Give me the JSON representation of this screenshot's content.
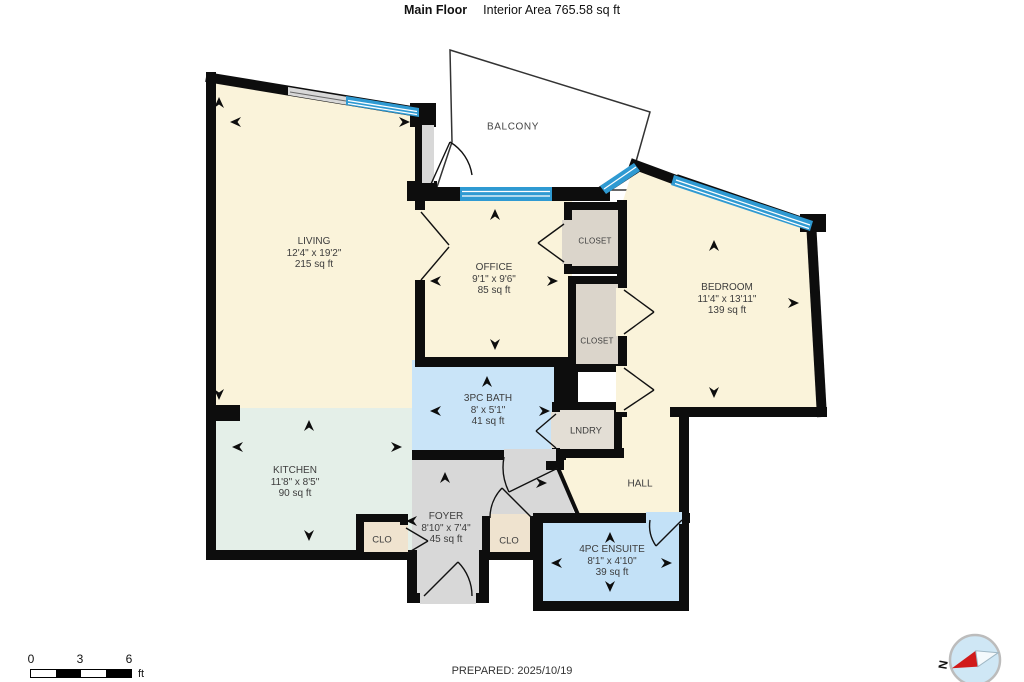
{
  "header": {
    "floor_label": "Main Floor",
    "area_label": "Interior Area 765.58 sq ft"
  },
  "rooms": {
    "living": {
      "name": "LIVING",
      "dims": "12'4\" x 19'2\"",
      "area": "215 sq ft"
    },
    "office": {
      "name": "OFFICE",
      "dims": "9'1\" x 9'6\"",
      "area": "85 sq ft"
    },
    "bedroom": {
      "name": "BEDROOM",
      "dims": "11'4\" x 13'11\"",
      "area": "139 sq ft"
    },
    "kitchen": {
      "name": "KITCHEN",
      "dims": "11'8\" x 8'5\"",
      "area": "90 sq ft"
    },
    "bath": {
      "name": "3PC BATH",
      "dims": "8' x 5'1\"",
      "area": "41 sq ft"
    },
    "foyer": {
      "name": "FOYER",
      "dims": "8'10\" x 7'4\"",
      "area": "45 sq ft"
    },
    "ensuite": {
      "name": "4PC ENSUITE",
      "dims": "8'1\" x 4'10\"",
      "area": "39 sq ft"
    },
    "balcony": {
      "name": "BALCONY"
    },
    "closet_upper": {
      "name": "CLOSET"
    },
    "closet_lower": {
      "name": "CLOSET"
    },
    "laundry": {
      "name": "LNDRY"
    },
    "hall": {
      "name": "HALL"
    },
    "clo_left": {
      "name": "CLO"
    },
    "clo_right": {
      "name": "CLO"
    }
  },
  "footer": {
    "prepared": "PREPARED: 2025/10/19",
    "scale_0": "0",
    "scale_3": "3",
    "scale_6": "6",
    "scale_unit": "ft",
    "compass_n": "N"
  },
  "colors": {
    "wall": "#0d0d0d",
    "room_cream": "#FAF3DA",
    "kitchen_mint": "#E4EFE8",
    "bath_blue": "#C9E4F8",
    "ensuite_blue": "#C3E1F7",
    "foyer_gray": "#D8D8D8",
    "closet_taupe": "#DBD5CB",
    "clo_beige": "#EFE3CF",
    "window_blue": "#2F9AD2",
    "compass_red": "#D11A1A"
  }
}
